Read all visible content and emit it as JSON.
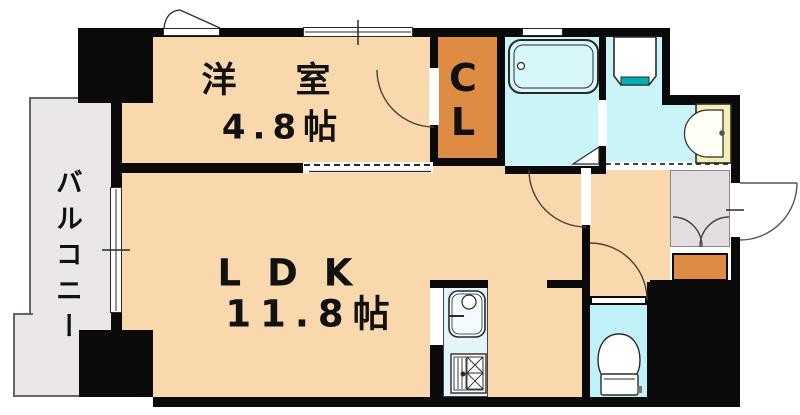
{
  "page": {
    "background": "#ffffff",
    "type": "apartment-floor-plan"
  },
  "rooms": {
    "western": {
      "name": "洋　室",
      "size": "4.8帖"
    },
    "ldk": {
      "name": "LDK",
      "size": "11.8帖"
    },
    "closet": {
      "line1": "C",
      "line2": "L"
    },
    "balcony": {
      "label": "バルコニー"
    }
  },
  "fixtures": {
    "bathtub": "bathtub",
    "washing_machine_pan": "washing-machine-pan",
    "vanity_basin": "vanity-basin",
    "toilet": "toilet",
    "kitchen_sink": "kitchen-sink",
    "gas_stove": "gas-stove",
    "shoe_box": "shoe-box",
    "entrance_storage": "entrance-storage-double-doors",
    "entrance_door": "entrance-swing-door",
    "sliding_partition": "sliding-door-dashed-track",
    "windows": [
      "casement-window",
      "sliding-window",
      "bathroom-window",
      "balcony-sliding-door"
    ]
  },
  "colors": {
    "floor": "#F8D8AC",
    "balcony": "#EAE6EA",
    "entrance": "#E2DEE2",
    "closet_orange": "#DE8C44",
    "bath_cyan": "#C9F5F9",
    "toilet_cyan": "#BFF2F8",
    "counter_cyan": "#E2F6F9",
    "tub_cyan": "#D8F7FA",
    "accent_teal": "#00AEB4",
    "vanity_yellow": "#F5F0B4",
    "wall": "#0A0A0A",
    "line": "#2A2A2A"
  }
}
